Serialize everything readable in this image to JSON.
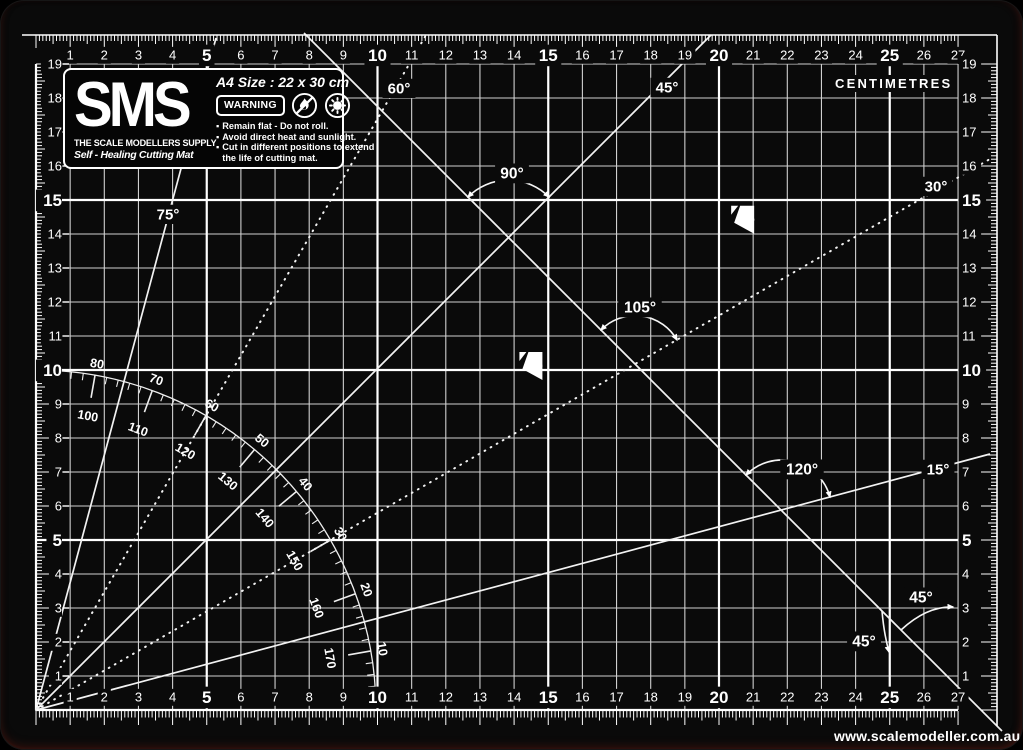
{
  "brand": {
    "logo": "SMS",
    "supplier": "THE SCALE MODELLERS SUPPLY",
    "product": "Self - Healing Cutting Mat",
    "size_label": "A4 Size : 22 x 30 cm",
    "warning_label": "WARNING",
    "warnings": [
      "Remain flat - Do not roll.",
      "Avoid direct heat and sunlight.",
      "Cut in different positions to extend the life of cutting mat."
    ]
  },
  "unit_label": "CENTIMETRES",
  "website": "www.scalemodeller.com.au",
  "rulers": {
    "top": [
      "1",
      "2",
      "3",
      "4",
      "5",
      "6",
      "7",
      "8",
      "9",
      "10",
      "11",
      "12",
      "13",
      "14",
      "15",
      "16",
      "17",
      "18",
      "19",
      "20",
      "21",
      "22",
      "23",
      "24",
      "25",
      "26",
      "27"
    ],
    "bottom": [
      "1",
      "2",
      "3",
      "4",
      "5",
      "6",
      "7",
      "8",
      "9",
      "10",
      "11",
      "12",
      "13",
      "14",
      "15",
      "16",
      "17",
      "18",
      "19",
      "20",
      "21",
      "22",
      "23",
      "24",
      "25",
      "26",
      "27"
    ],
    "left": [
      "1",
      "2",
      "3",
      "4",
      "5",
      "6",
      "7",
      "8",
      "9",
      "10",
      "11",
      "12",
      "13",
      "14",
      "15",
      "16",
      "17",
      "18",
      "19"
    ],
    "right": [
      "1",
      "2",
      "3",
      "4",
      "5",
      "6",
      "7",
      "8",
      "9",
      "10",
      "11",
      "12",
      "13",
      "14",
      "15",
      "16",
      "17",
      "18",
      "19"
    ],
    "bold_numbers": [
      5,
      10,
      15,
      20,
      25
    ]
  },
  "protractor": {
    "outer_labels": [
      "80",
      "70",
      "60",
      "50",
      "40",
      "30",
      "20",
      "10"
    ],
    "inner_labels": [
      "100",
      "110",
      "120",
      "130",
      "140",
      "150",
      "160",
      "170"
    ]
  },
  "angle_lines": [
    {
      "label": "75°",
      "angle": 75,
      "style": "solid"
    },
    {
      "label": "60°",
      "angle": 60,
      "style": "dotted"
    },
    {
      "label": "45°",
      "angle": 45,
      "style": "solid"
    },
    {
      "label": "30°",
      "angle": 30,
      "style": "dotted"
    },
    {
      "label": "15°",
      "angle": 15,
      "style": "solid"
    },
    {
      "label": "",
      "angle": -45,
      "style": "solid"
    }
  ],
  "angle_annotations": [
    {
      "label": "90°"
    },
    {
      "label": "105°"
    },
    {
      "label": "120°"
    },
    {
      "label": "45°"
    },
    {
      "label": "45°"
    }
  ],
  "paper_markers": [
    {
      "label": "A5",
      "x_cm": 21,
      "y_cm": 14.8
    },
    {
      "label": "A6",
      "x_cm": 14.8,
      "y_cm": 10.5
    }
  ],
  "colors": {
    "mat": "#0a0a0a",
    "grid_minor": "#d0d0d0",
    "grid_major": "#ffffff",
    "ink": "#ffffff"
  }
}
